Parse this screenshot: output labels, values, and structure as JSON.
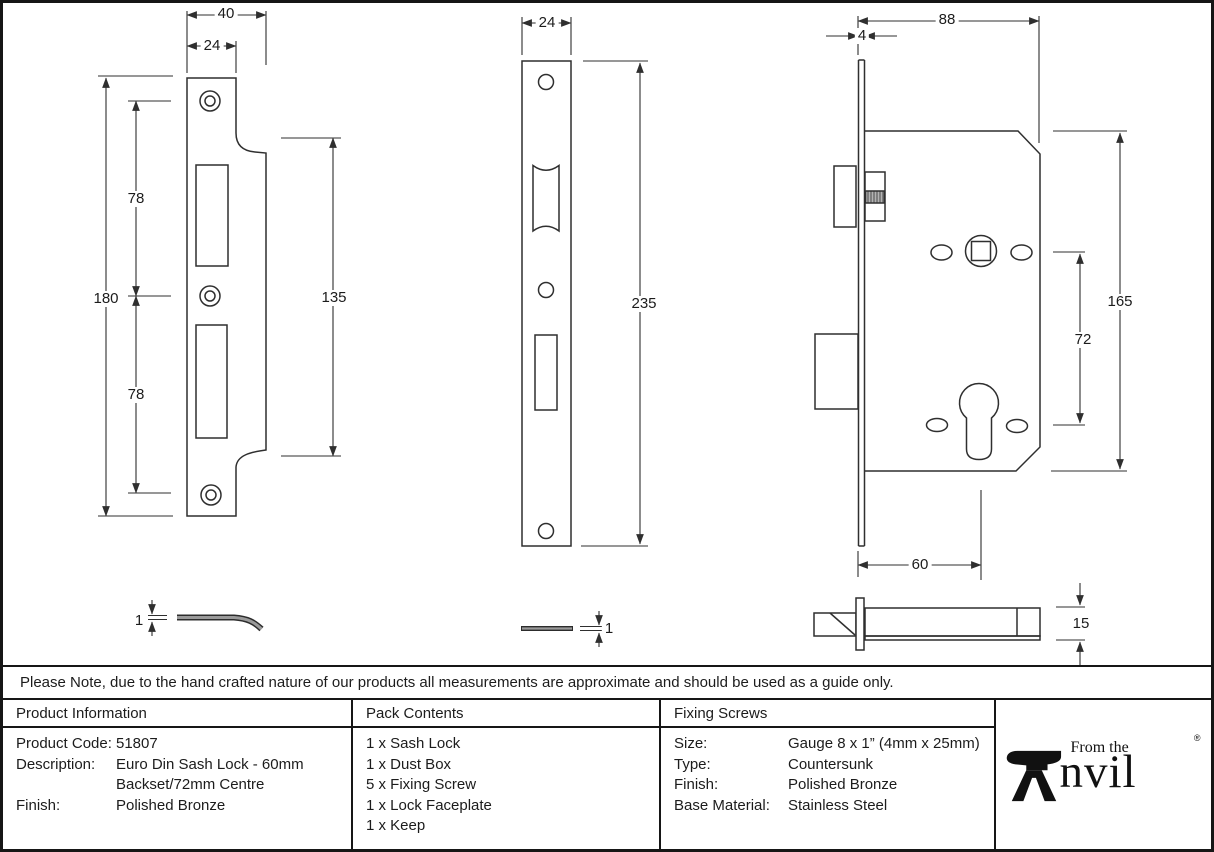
{
  "drawings": {
    "keep_front": {
      "width": "40",
      "slot_width": "24",
      "overall_height": "180",
      "upper_hole_spacing": "78",
      "lower_hole_spacing": "78",
      "lip_height": "135"
    },
    "keep_side": {
      "thickness": "1"
    },
    "faceplate_front": {
      "width": "24",
      "height": "235"
    },
    "faceplate_side": {
      "thickness": "1"
    },
    "lock_front": {
      "depth": "88",
      "faceplate_thickness": "4",
      "height": "165",
      "centres": "72",
      "backset": "60"
    },
    "lock_side": {
      "thickness": "15"
    }
  },
  "note": "Please Note, due to the hand crafted nature of our products all measurements are approximate and should be used as a guide only.",
  "table": {
    "product_information": {
      "header": "Product Information",
      "rows": [
        {
          "label": "Product Code:",
          "lines": [
            "51807"
          ]
        },
        {
          "label": "Description:",
          "lines": [
            "Euro Din Sash Lock - 60mm",
            "Backset/72mm Centre"
          ]
        },
        {
          "label": "Finish:",
          "lines": [
            "Polished Bronze"
          ]
        }
      ]
    },
    "pack_contents": {
      "header": "Pack Contents",
      "items": [
        "1 x Sash Lock",
        "1 x Dust Box",
        "5 x Fixing Screw",
        "1 x Lock Faceplate",
        "1 x Keep"
      ]
    },
    "fixing_screws": {
      "header": "Fixing Screws",
      "rows": [
        {
          "label": "Size:",
          "value": "Gauge 8 x 1” (4mm x 25mm)"
        },
        {
          "label": "Type:",
          "value": "Countersunk"
        },
        {
          "label": "Finish:",
          "value": "Polished Bronze"
        },
        {
          "label": "Base Material:",
          "value": "Stainless Steel"
        }
      ]
    }
  },
  "logo": {
    "tagline": "From the",
    "name": "Anvil",
    "name_tail": "nvil",
    "registered": "®"
  }
}
